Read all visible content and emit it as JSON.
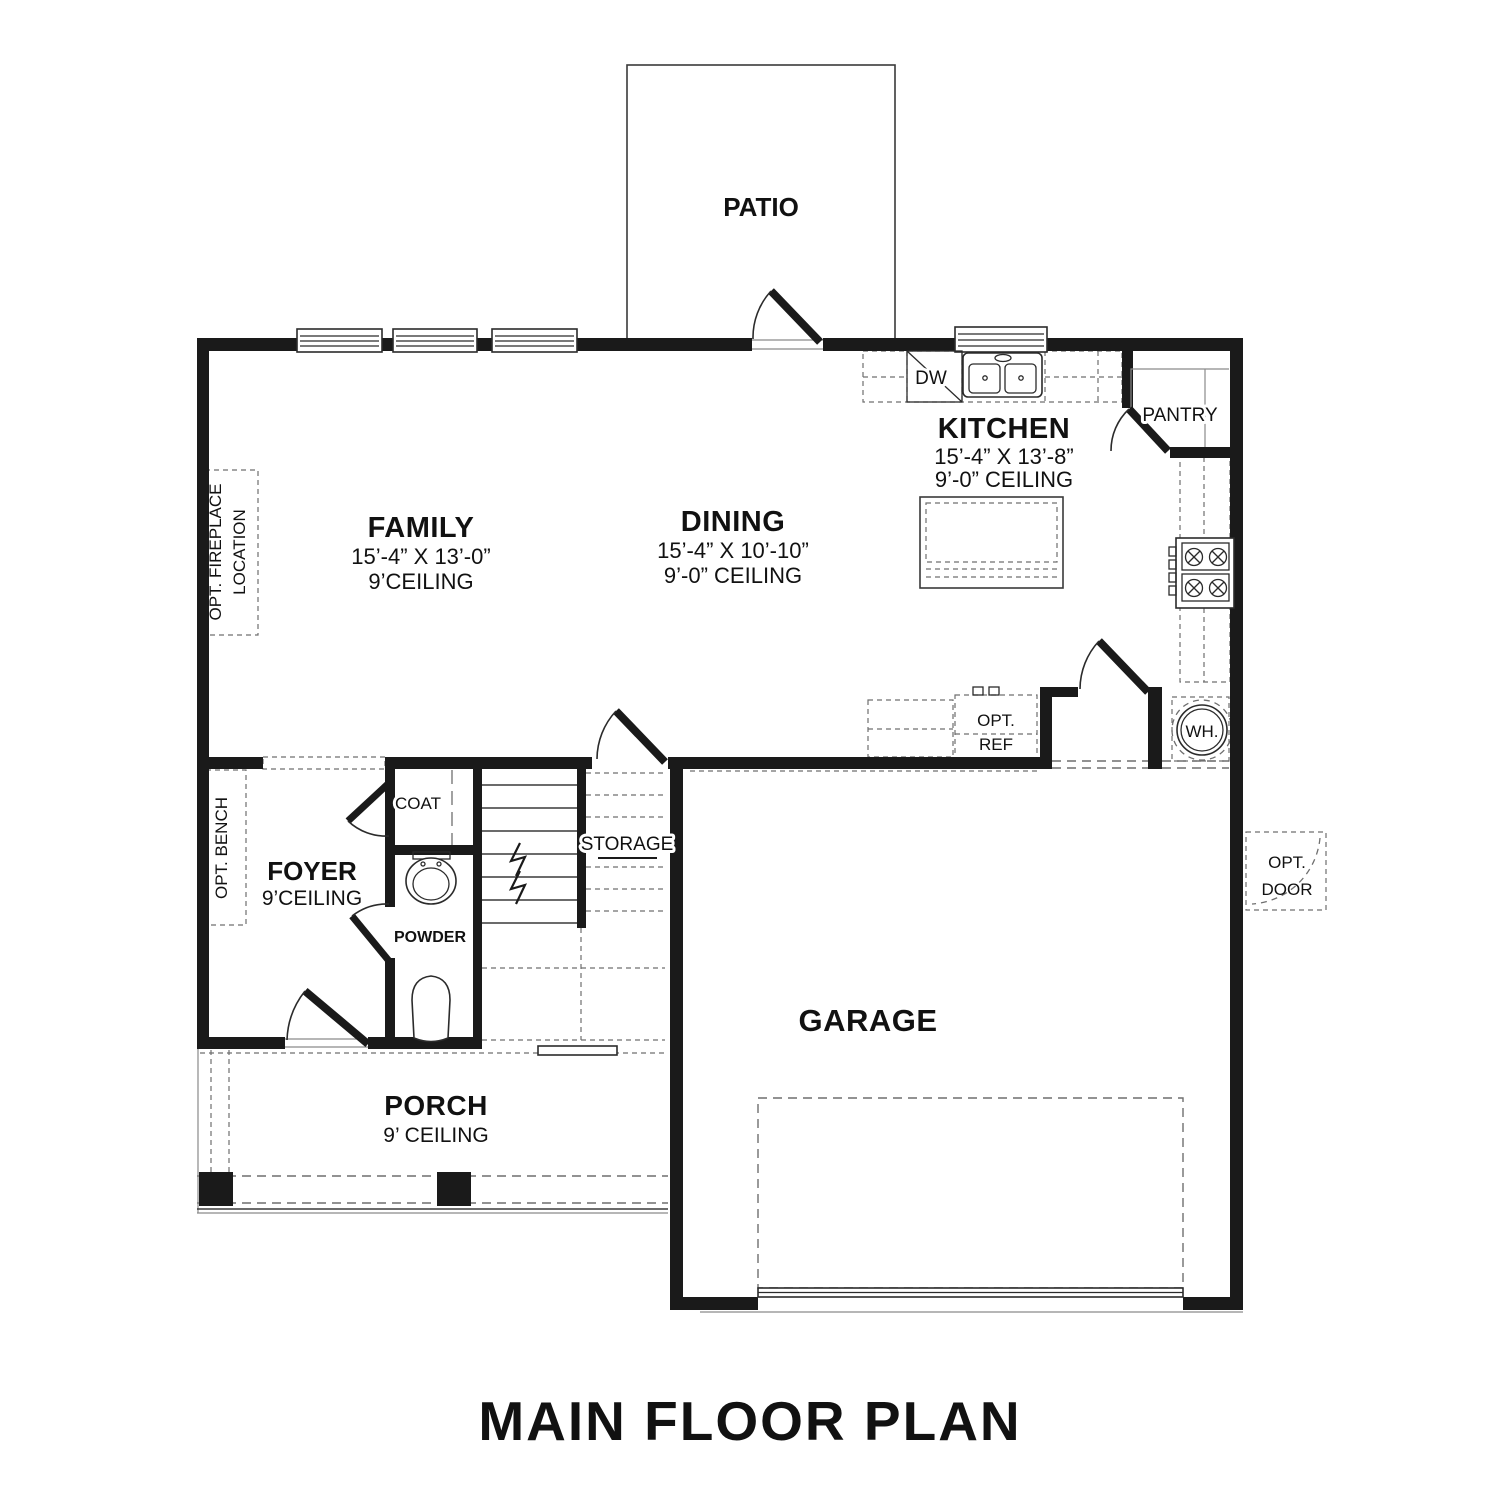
{
  "title": "MAIN FLOOR PLAN",
  "rooms": {
    "patio": {
      "name": "PATIO"
    },
    "family": {
      "name": "FAMILY",
      "dimensions": "15’-4” X 13’-0”",
      "ceiling": "9’CEILING"
    },
    "dining": {
      "name": "DINING",
      "dimensions": "15’-4” X 10’-10”",
      "ceiling": "9’-0” CEILING"
    },
    "kitchen": {
      "name": "KITCHEN",
      "dimensions": "15’-4” X 13’-8”",
      "ceiling": "9’-0” CEILING"
    },
    "pantry": {
      "name": "PANTRY"
    },
    "foyer": {
      "name": "FOYER",
      "ceiling": "9’CEILING"
    },
    "coat": {
      "name": "COAT"
    },
    "powder": {
      "name": "POWDER"
    },
    "storage": {
      "name": "STORAGE"
    },
    "garage": {
      "name": "GARAGE"
    },
    "porch": {
      "name": "PORCH",
      "ceiling": "9’ CEILING"
    }
  },
  "labels": {
    "dishwasher": "DW",
    "water_heater": "WH.",
    "opt_ref": {
      "line1": "OPT.",
      "line2": "REF"
    },
    "opt_door": {
      "line1": "OPT.",
      "line2": "DOOR"
    },
    "opt_bench": "OPT. BENCH",
    "opt_fireplace": {
      "line1": "OPT. FIREPLACE",
      "line2": "LOCATION"
    }
  },
  "colors": {
    "wall": "#1a1a1a",
    "line": "#3a3a3a",
    "dash": "#6f6f6f",
    "background": "#ffffff",
    "text": "#111111"
  }
}
